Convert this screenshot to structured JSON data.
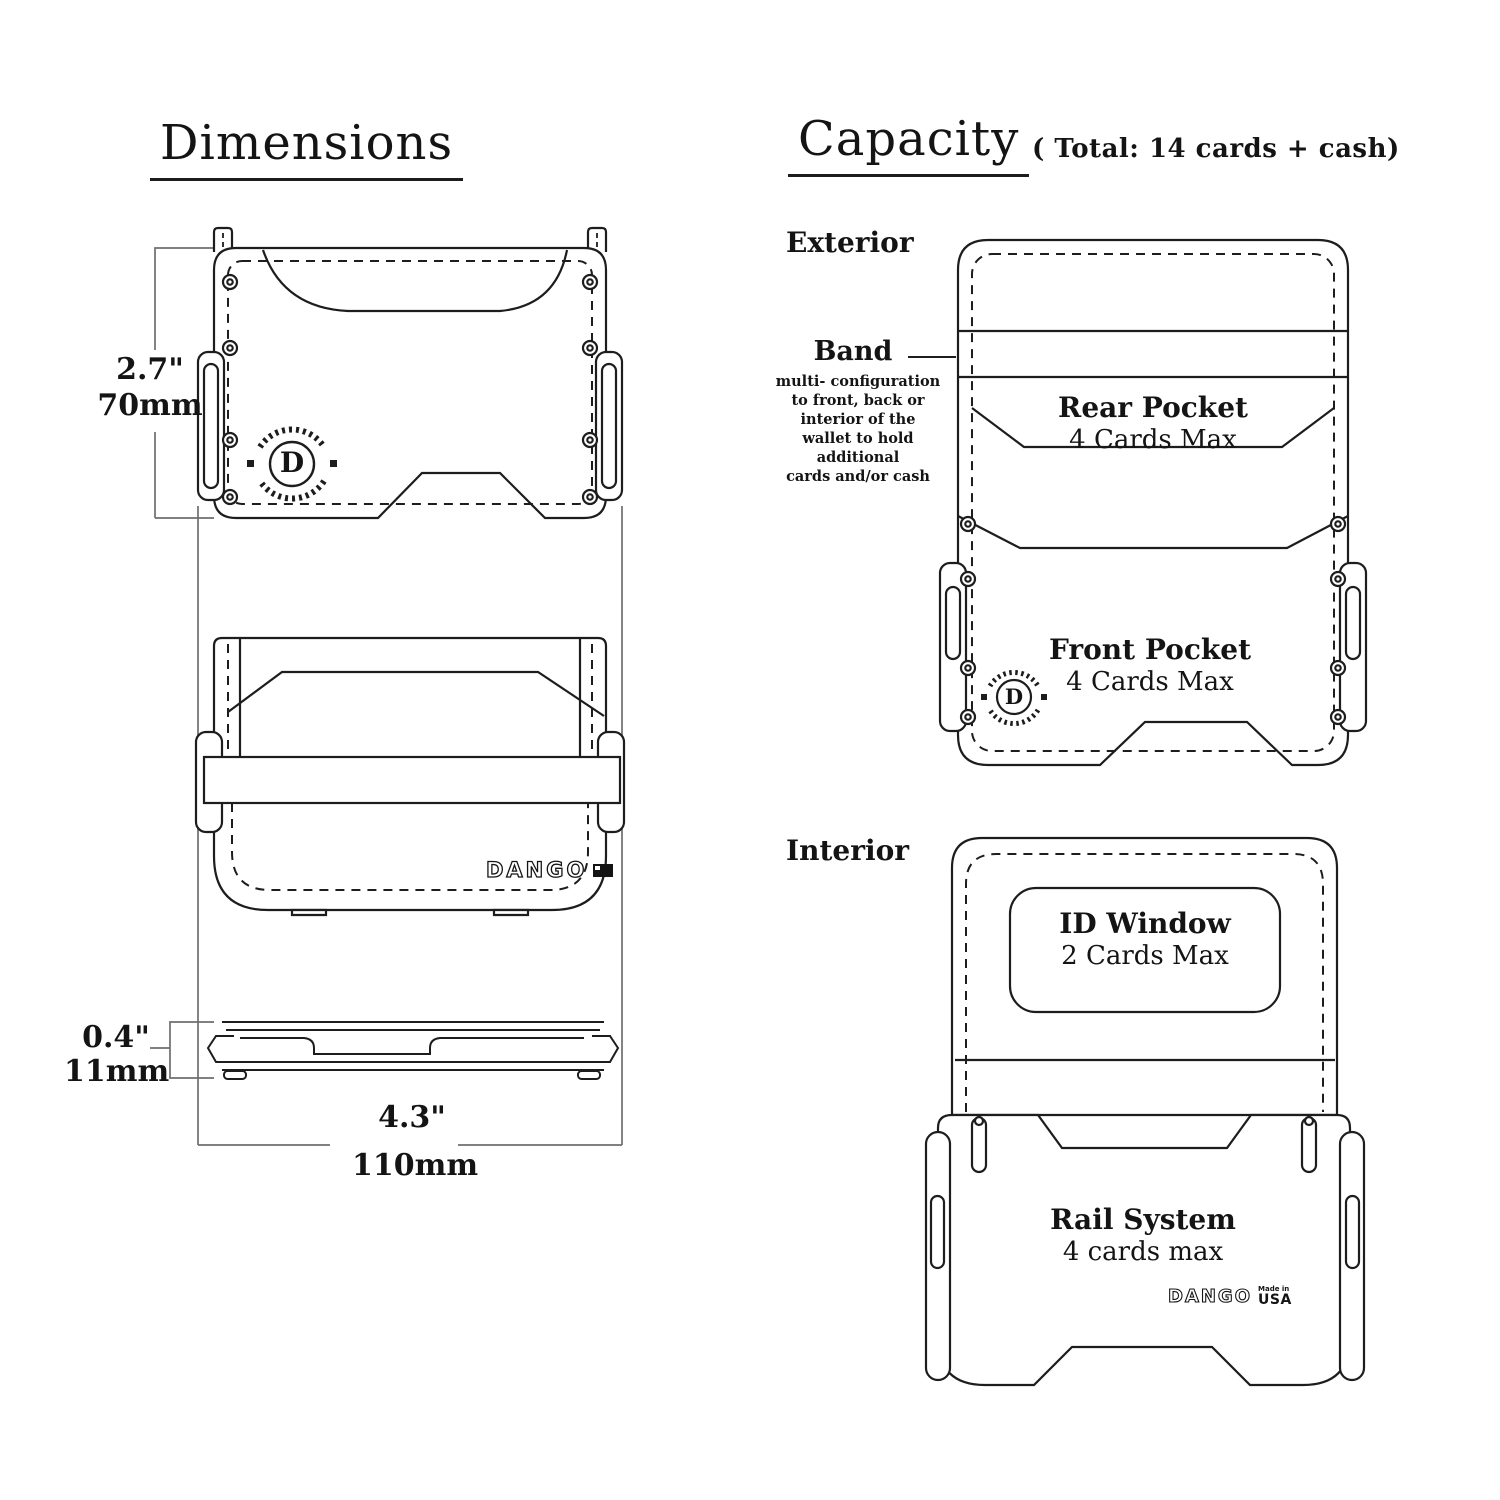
{
  "colors": {
    "ink": "#141414",
    "dim_lines": "#6e6e6e",
    "background": "#ffffff"
  },
  "dimensions": {
    "title": "Dimensions",
    "height_in": "2.7\"",
    "height_mm": "70mm",
    "width_in": "4.3\"",
    "width_mm": "110mm",
    "thickness_in": "0.4\"",
    "thickness_mm": "11mm",
    "logo": "DANGO",
    "badge_letter": "D"
  },
  "capacity": {
    "title": "Capacity",
    "note": "( Total: 14 cards + cash)",
    "exterior_label": "Exterior",
    "interior_label": "Interior",
    "band_label": "Band",
    "band_desc_lines": [
      "multi- configuration",
      "to front, back or",
      "interior of the",
      "wallet to hold additional",
      "cards and/or cash"
    ],
    "rear_pocket_name": "Rear Pocket",
    "rear_pocket_capacity": "4 Cards Max",
    "front_pocket_name": "Front Pocket",
    "front_pocket_capacity": "4 Cards Max",
    "id_window_name": "ID Window",
    "id_window_capacity": "2 Cards Max",
    "rail_system_name": "Rail System",
    "rail_system_capacity": "4 cards max",
    "interior_logo": "DANGO",
    "made_in": "Made in",
    "usa": "USA",
    "badge_letter": "D"
  }
}
